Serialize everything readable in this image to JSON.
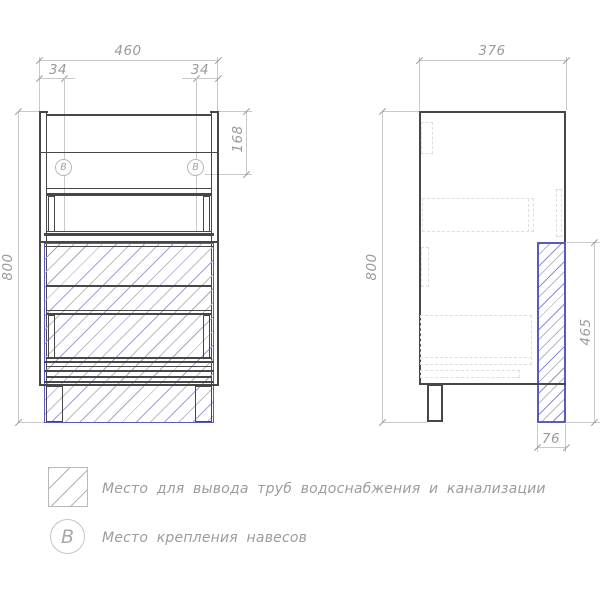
{
  "front_view": {
    "dim_width": "460",
    "dim_offset_left": "34",
    "dim_offset_right": "34",
    "dim_height": "800",
    "dim_hanger_drop": "168",
    "marker_label": "B"
  },
  "side_view": {
    "dim_depth": "376",
    "dim_height": "800",
    "dim_pipe_zone_height": "465",
    "dim_pipe_zone_depth": "76"
  },
  "legend": {
    "pipe_zone_label": "Место для вывода труб водоснабжения и канализации",
    "hanger_label": "Место крепления навесов",
    "marker_label": "B"
  },
  "colors": {
    "line_dark": "#474747",
    "dimension_gray": "#9b9b9b",
    "pipe_zone_accent": "#5a5ac2",
    "hatch_blue": "#9a9ad6",
    "hatch_gray": "#bcbcc6"
  }
}
